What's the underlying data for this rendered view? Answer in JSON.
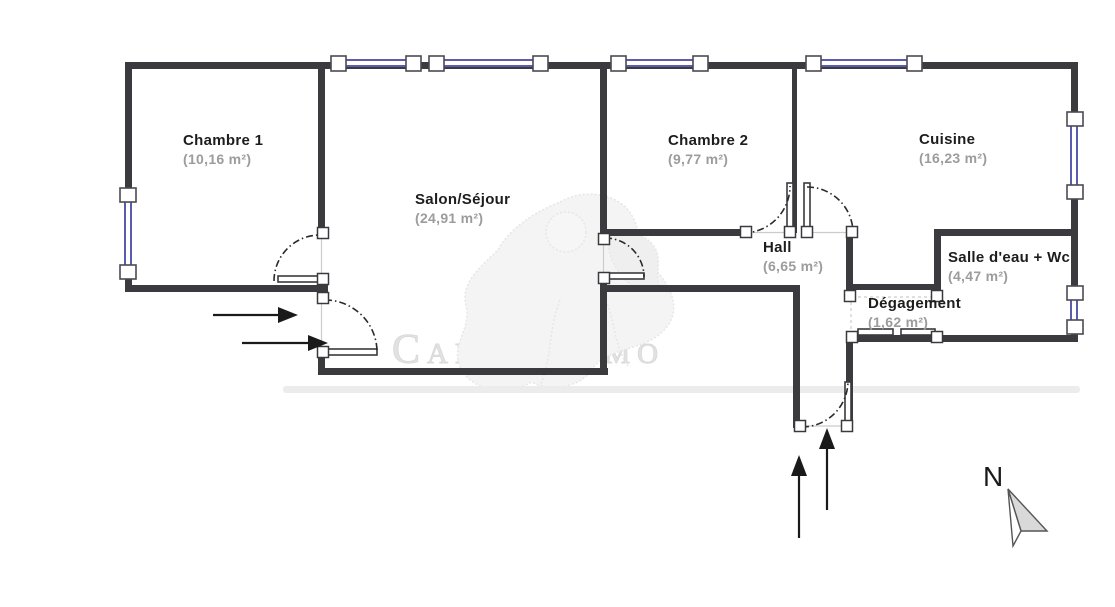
{
  "plan": {
    "title": "Floor plan",
    "rooms": [
      {
        "id": "chambre1",
        "name": "Chambre 1",
        "area": "(10,16 m²)"
      },
      {
        "id": "salon",
        "name": "Salon/Séjour",
        "area": "(24,91 m²)"
      },
      {
        "id": "chambre2",
        "name": "Chambre 2",
        "area": "(9,77 m²)"
      },
      {
        "id": "cuisine",
        "name": "Cuisine",
        "area": "(16,23 m²)"
      },
      {
        "id": "hall",
        "name": "Hall",
        "area": "(6,65 m²)"
      },
      {
        "id": "salle_eau",
        "name": "Salle d'eau + Wc",
        "area": "(4,47 m²)"
      },
      {
        "id": "degagement",
        "name": "Dégagement",
        "area": "(1,62 m²)"
      }
    ],
    "compass": {
      "label": "N",
      "icon": "north-arrow-icon"
    },
    "watermark": {
      "text": "CannisImmo",
      "icon": "watermark-figure"
    },
    "icons": {
      "entrance": "arrow-up-icon",
      "side_access": "arrow-right-icon",
      "doors": "door-swing-icon"
    },
    "colors": {
      "wall": "#3a3a3f",
      "window_blue": "#5b5bb0",
      "room_text": "#1d1d1d",
      "area_text": "#9c9c9c",
      "watermark_gray": "#e2e2e2",
      "background": "#ffffff"
    }
  }
}
